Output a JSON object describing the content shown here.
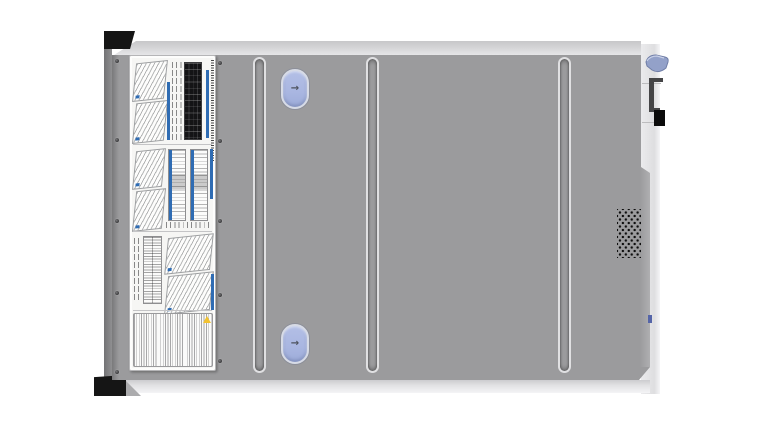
{
  "icons": {
    "arrow_right": "→"
  },
  "colors": {
    "cover": "#9b9b9d",
    "stripTop": "#d7d7d9",
    "stripRight": "#ebebed",
    "stripBottom": "#e3e3e5",
    "earBlack": "#151515",
    "labelBg": "#f6f6f4",
    "labelBorder": "#b5b5b7",
    "labelBlue": "#2f6cb3",
    "latchFill": "#a9b6e1",
    "latchRing": "#d7dbe6",
    "latchEdge": "#8c8f99",
    "arrowColor": "#4e535e",
    "ventDot": "#0e0e0e",
    "hookBlue": "#93a1c9",
    "bracketDark": "#454547",
    "blockBlack": "#0b0b0b",
    "screw": "#3e3e40",
    "tickBlue": "#5565a8",
    "warnYellow": "#f2c230"
  },
  "chassis": {
    "ridges": {
      "lefts": [
        141,
        254,
        446
      ]
    },
    "screws": [
      [
        3,
        4
      ],
      [
        3,
        83
      ],
      [
        3,
        164
      ],
      [
        3,
        236
      ],
      [
        3,
        315
      ],
      [
        106,
        6
      ],
      [
        106,
        84
      ],
      [
        106,
        164
      ],
      [
        106,
        238
      ],
      [
        106,
        304
      ]
    ],
    "latches": [
      {
        "left": 169,
        "top": 14
      },
      {
        "left": 169,
        "top": 269
      }
    ]
  }
}
